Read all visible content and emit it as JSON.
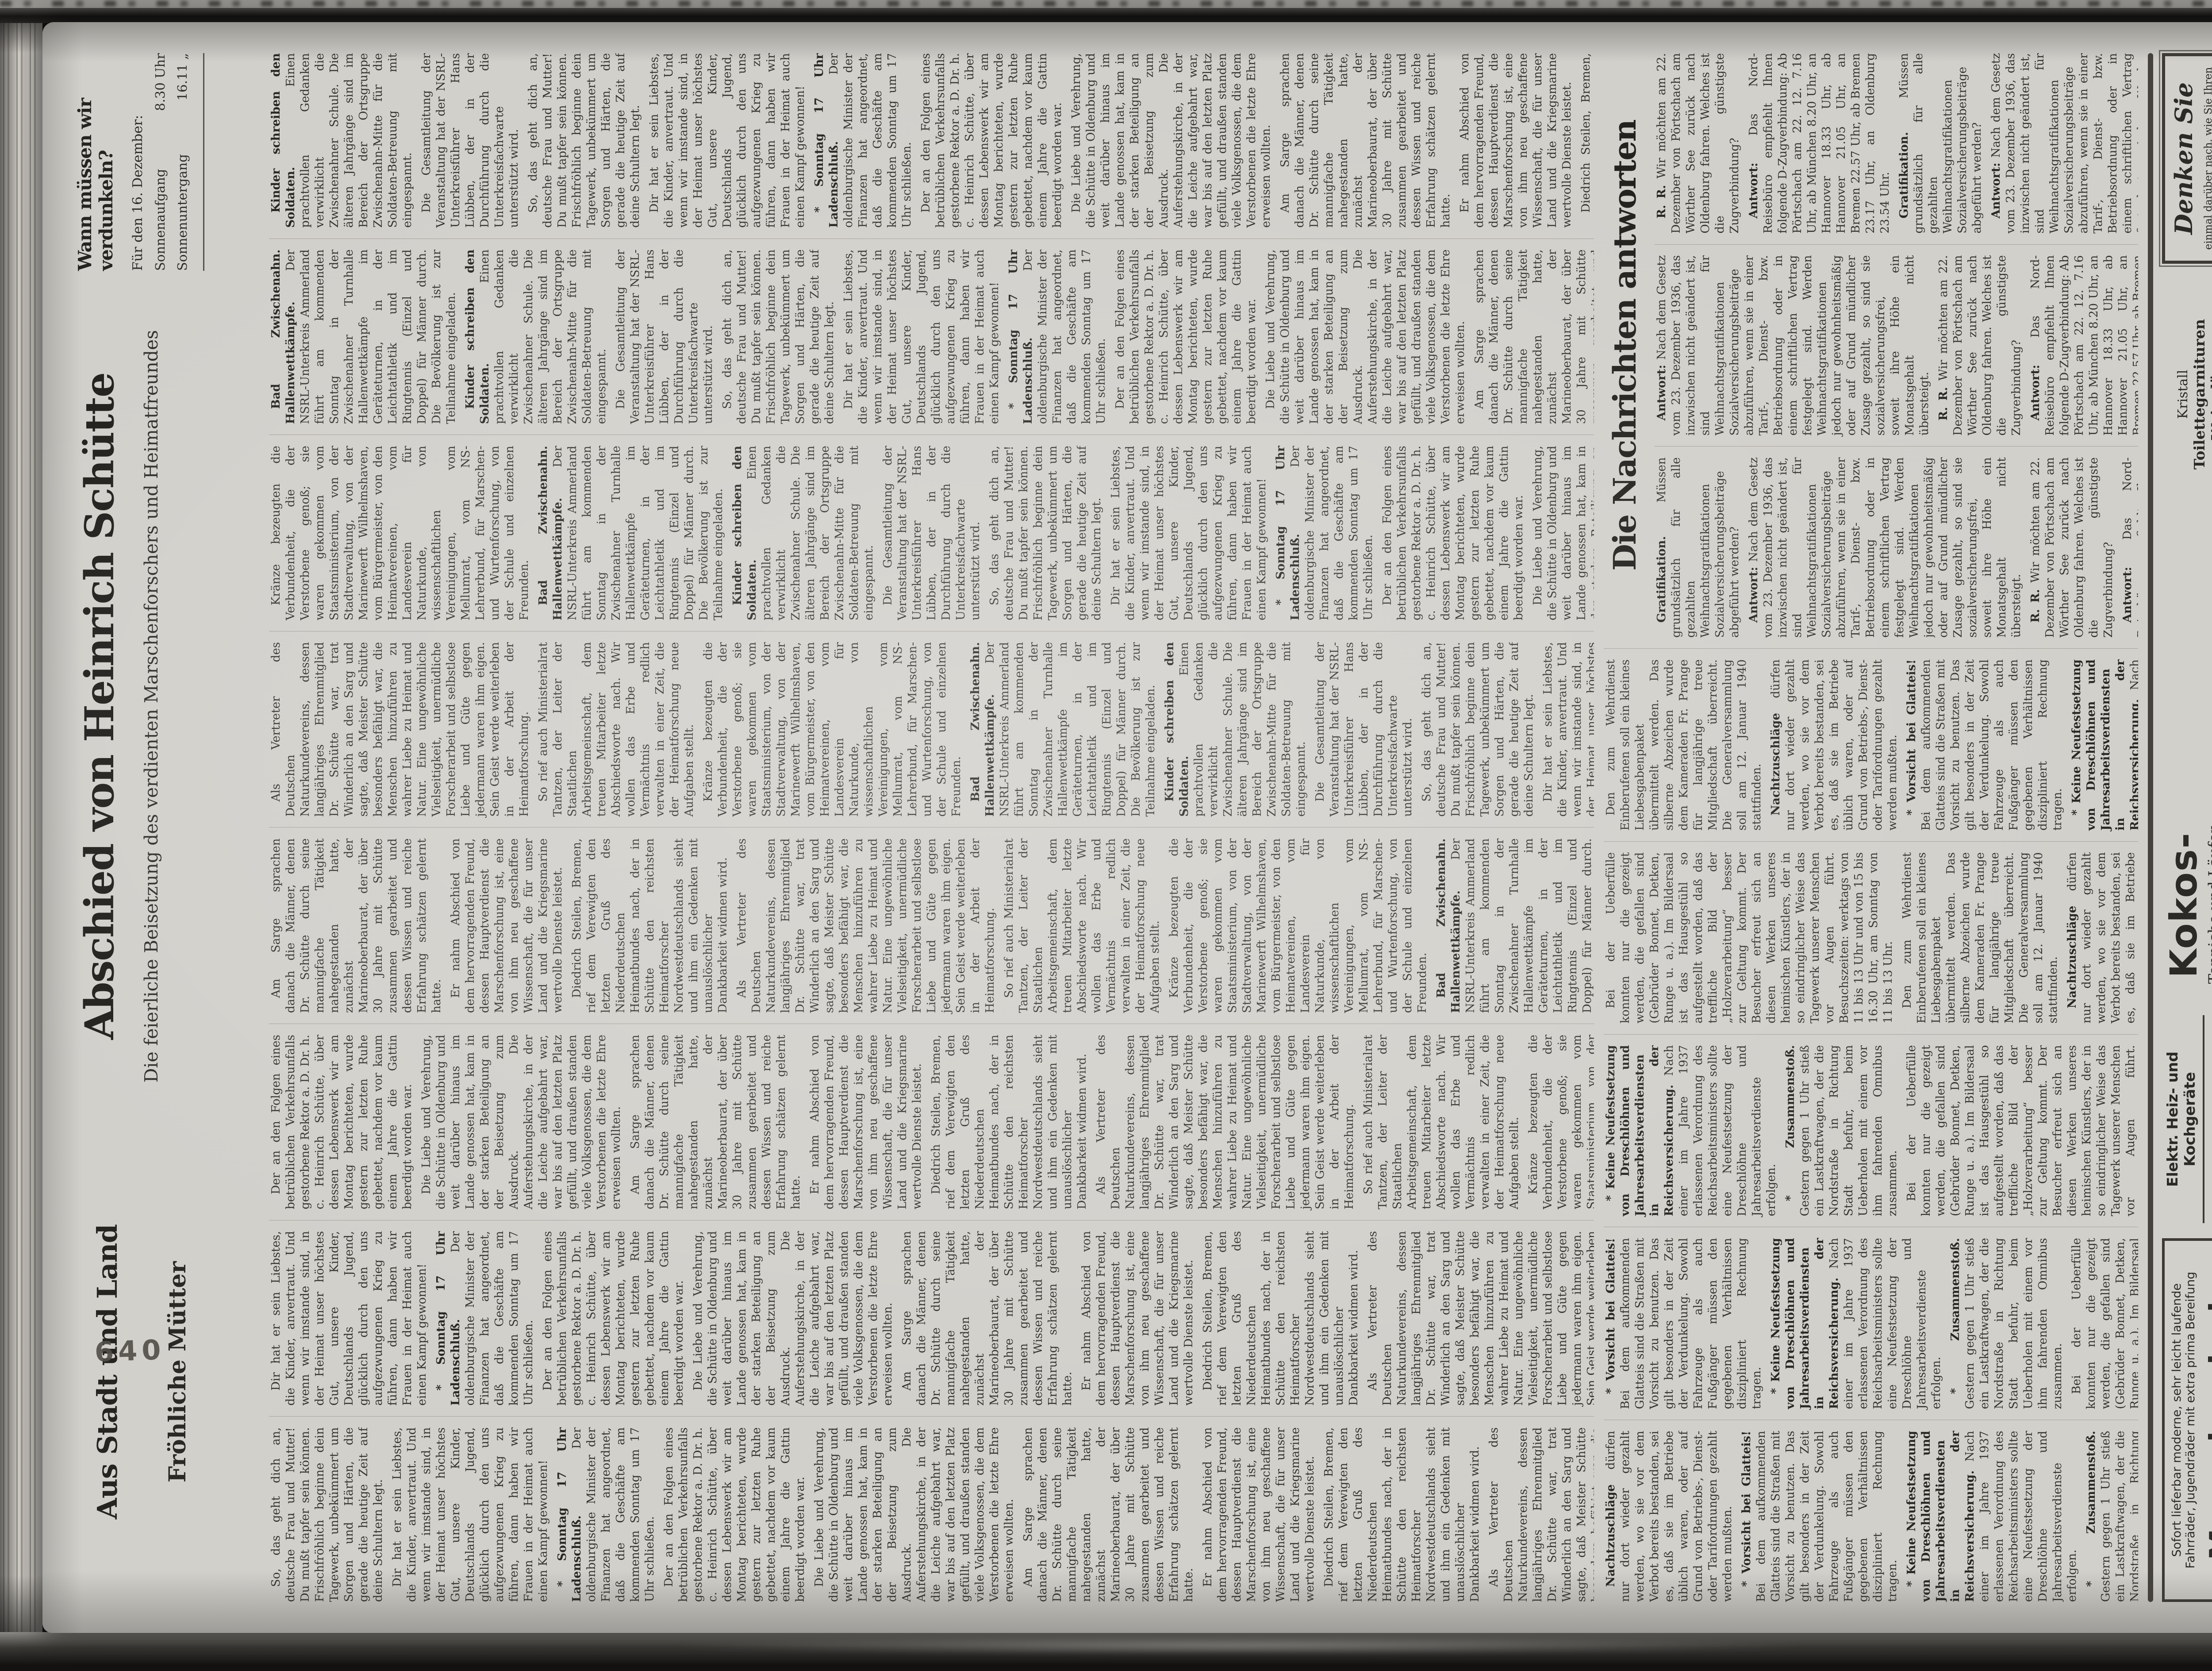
{
  "page": {
    "folio_stamp": "640",
    "colors": {
      "paper": "#d2d0cb",
      "ink": "#2f2d2a",
      "surround": "#141312"
    }
  },
  "headers": {
    "local": {
      "title": "Aus Stadt und Land",
      "subhead": "Fröhliche Mütter"
    },
    "obituary": {
      "title": "Abschied von Heinrich Schütte",
      "subtitle": "Die feierliche Beisetzung des verdienten Marschenforschers und Heimatfreundes"
    },
    "blackout": {
      "title": "Wann müssen wir verdunkeln?",
      "dateline": "Für den 16. Dezember:",
      "rows": [
        {
          "label": "Sonnenaufgang",
          "value": "8.30 Uhr"
        },
        {
          "label": "Sonnenuntergang",
          "value": "16.11 „"
        }
      ]
    },
    "qa_section": {
      "title": "Die Nachrichten antworten"
    }
  },
  "body_pools": {
    "main": [
      {
        "lead": "",
        "text": "So, das geht dich an, deutsche Frau und Mutter! Du mußt tapfer sein können. Frischfröhlich beginne dein Tagewerk, unbekümmert um Sorgen und Härten, die gerade die heutige Zeit auf deine Schultern legt."
      },
      {
        "lead": "",
        "text": "Dir hat er sein Liebstes, die Kinder, anvertraut. Und wenn wir imstande sind, in der Heimat unser höchstes Gut, unsere Kinder, Deutschlands Jugend, glücklich durch den uns aufgezwungenen Krieg zu führen, dann haben wir Frauen in der Heimat auch einen Kampf gewonnen!"
      },
      {
        "lead": "* Sonntag 17 Uhr Ladenschluß.",
        "text": "Der oldenburgische Minister der Finanzen hat angeordnet, daß die Geschäfte am kommenden Sonntag um 17 Uhr schließen."
      },
      {
        "lead": "",
        "text": "Der an den Folgen eines betrüblichen Verkehrsunfalls gestorbene Rektor a. D. Dr. h. c. Heinrich Schütte, über dessen Lebenswerk wir am Montag berichteten, wurde gestern zur letzten Ruhe gebettet, nachdem vor kaum einem Jahre die Gattin beerdigt worden war."
      },
      {
        "lead": "",
        "text": "Die Liebe und Verehrung, die Schütte in Oldenburg und weit darüber hinaus im Lande genossen hat, kam in der starken Beteiligung an der Beisetzung zum Ausdruck. Die Auferstehungskirche, in der die Leiche aufgebahrt war, war bis auf den letzten Platz gefüllt, und draußen standen viele Volksgenossen, die dem Verstorbenen die letzte Ehre erweisen wollten."
      },
      {
        "lead": "",
        "text": "Am Sarge sprachen danach die Männer, denen Dr. Schütte durch seine mannigfache Tätigkeit nahegestanden hatte, zunächst der Marineoberbaurat, der über 30 Jahre mit Schütte zusammen gearbeitet und dessen Wissen und reiche Erfahrung schätzen gelernt hatte."
      },
      {
        "lead": "",
        "text": "Er nahm Abschied von dem hervorragenden Freund, dessen Hauptverdienst die Marschenforschung ist, eine von ihm neu geschaffene Wissenschaft, die für unser Land und die Kriegsmarine wertvolle Dienste leistet."
      },
      {
        "lead": "",
        "text": "Diedrich Steilen, Bremen, rief dem Verewigten den letzten Gruß des Niederdeutschen Heimatbundes nach, der in Schütte den reichsten Heimatforscher Nordwestdeutschlands sieht und ihm ein Gedenken mit unauslöschlicher Dankbarkeit widmen wird."
      },
      {
        "lead": "",
        "text": "Als Vertreter des Deutschen Naturkundevereins, dessen langjähriges Ehrenmitglied Dr. Schütte war, trat Winderlich an den Sarg und sagte, daß Meister Schütte besonders befähigt war, die Menschen hinzuführen zu wahrer Liebe zu Heimat und Natur. Eine ungewöhnliche Vielseitigkeit, unermüdliche Forscherarbeit und selbstlose Liebe und Güte gegen jedermann waren ihm eigen. Sein Geist werde weiterleben in der Arbeit der Heimatforschung."
      },
      {
        "lead": "",
        "text": "So rief auch Ministerialrat Tantzen, der Leiter der Staatlichen Arbeitsgemeinschaft, dem treuen Mitarbeiter letzte Abschiedsworte nach. Wir wollen das Erbe und Vermächtnis redlich verwalten in einer Zeit, die der Heimatforschung neue Aufgaben stellt."
      },
      {
        "lead": "",
        "text": "Kränze bezeugten die Verbundenheit, die der Verstorbene genoß; sie waren gekommen vom Staatsministerium, von der Stadtverwaltung, von der Marinewerft Wilhelmshaven, vom Bürgermeister, von den Heimatvereinen, vom Landesverein für Naturkunde, von wissenschaftlichen Vereinigungen, vom Mellumrat, vom NS-Lehrerbund, für Marschen- und Wurtenforschung, von der Schule und einzelnen Freunden."
      },
      {
        "lead": "Bad Zwischenahn. Hallenwettkämpfe.",
        "text": "Der NSRL-Unterkreis Ammerland führt am kommenden Sonntag in der Zwischenahner Turnhalle Hallenwettkämpfe im Geräteturnen, in der Leichtathletik und im Ringtennis (Einzel und Doppel) für Männer durch. Die Bevölkerung ist zur Teilnahme eingeladen."
      },
      {
        "lead": "Kinder schreiben den Soldaten.",
        "text": "Einen prachtvollen Gedanken verwirklicht die Zwischenahner Schule. Die älteren Jahrgänge sind im Bereich der Ortsgruppe Zwischenahn-Mitte für die Soldaten-Betreuung mit eingespannt."
      },
      {
        "lead": "",
        "text": "Die Gesamtleitung der Veranstaltung hat der NSRL-Unterkreisführer Hans Lübben, der in der Durchführung durch die Unterkreisfachwarte unterstützt wird."
      }
    ],
    "briefs": [
      {
        "lead": "Nachtzuschläge",
        "text": "dürfen nur dort wieder gezahlt werden, wo sie vor dem Verbot bereits bestanden, sei es, daß sie im Betriebe üblich waren, oder auf Grund von Betriebs-, Dienst- oder Tarifordnungen gezahlt werden mußten."
      },
      {
        "lead": "* Vorsicht bei Glatteis!",
        "text": "Bei dem aufkommenden Glatteis sind die Straßen mit Vorsicht zu benutzen. Das gilt besonders in der Zeit der Verdunkelung. Sowohl Fahrzeuge als auch Fußgänger müssen den gegebenen Verhältnissen diszipliniert Rechnung tragen."
      },
      {
        "lead": "* Keine Neufestsetzung von Dreschlöhnen und Jahresarbeitsverdiensten in der Reichsversicherung.",
        "text": "Nach einer im Jahre 1937 erlassenen Verordnung des Reichsarbeitsministers sollte eine Neufestsetzung der Dreschlöhne und Jahresarbeitsverdienste erfolgen."
      },
      {
        "lead": "* Zusammenstoß.",
        "text": "Gestern gegen 1 Uhr stieß ein Lastkraftwagen, der die Nordstraße in Richtung Stadt befuhr, beim Ueberholen mit einem vor ihm fahrenden Omnibus zusammen."
      },
      {
        "lead": "",
        "text": "Bei der Ueberfülle konnten nur die gezeigt werden, die gefallen sind (Gebrüder Bonnet, Detken, Runge u. a.). Im Bildersaal ist das Hausgestühl so aufgestellt worden, daß das treffliche Bild der „Holzverarbeitung“ besser zur Geltung kommt. Der Besucher erfreut sich an diesen Werken unseres heimischen Künstlers, der in so eindringlicher Weise das Tagewerk unserer Menschen vor Augen führt. Besuchszeiten: werktags von 11 bis 13 Uhr und von 15 bis 16.30 Uhr, am Sonntag von 11 bis 13 Uhr."
      },
      {
        "lead": "",
        "text": "Den zum Wehrdienst Einberufenen soll ein kleines Liebesgabenpaket übermittelt werden. Das silberne Abzeichen wurde dem Kameraden Fr. Prange für langjährige treue Mitgliedschaft überreicht. Die Generalversammlung soll am 12. Januar 1940 stattfinden."
      }
    ],
    "qa": [
      {
        "lead": "Gratifikation.",
        "text": "Müssen grundsätzlich für alle gezahlten Weihnachtsgratifikationen Sozialversicherungsbeiträge abgeführt werden?"
      },
      {
        "lead": "Antwort:",
        "text": "Nach dem Gesetz vom 23. Dezember 1936, das inzwischen nicht geändert ist, sind für Weihnachtsgratifikationen Sozialversicherungsbeiträge abzuführen, wenn sie in einer Tarif-, Dienst- bzw. Betriebsordnung oder in einem schriftlichen Vertrag festgelegt sind. Werden Weihnachtsgratifikationen jedoch nur gewohnheitsmäßig oder auf Grund mündlicher Zusage gezahlt, so sind sie sozialversicherungsfrei, soweit ihre Höhe ein Monatsgehalt nicht übersteigt."
      },
      {
        "lead": "R. R.",
        "text": "Wir möchten am 22. Dezember von Pörtschach am Wörther See zurück nach Oldenburg fahren. Welches ist die günstigste Zugverbindung?"
      },
      {
        "lead": "Antwort:",
        "text": "Das Nord-Reisebüro empfiehlt Ihnen folgende D-Zugverbindung: Ab Pörtschach am 22. 12. 7.16 Uhr, ab München 8.20 Uhr, an Hannover 18.33 Uhr, ab Hannover 21.05 Uhr, an Bremen 22.57 Uhr, ab Bremen 23.17 Uhr, an Oldenburg 23.54 Uhr."
      }
    ]
  },
  "ads": {
    "munderloh": {
      "line1": "Sofort lieferbar moderne, sehr leicht laufende",
      "line2": "Fahrräder, Jugendräder mit extra prima Bereifung",
      "name": "Munderloh",
      "address": "Oldenburg, Lange Straße 78"
    },
    "stoever": {
      "line1": "Elektr. Heiz- und Kochgeräte",
      "product": "Gasherde",
      "name": "Fritz Stöver",
      "address": "Staustr. 9"
    },
    "kokos": {
      "big": "Kokos-",
      "line2": "Teppiche und Läufer",
      "name": "Aug. Gellermann",
      "address": "Haarenstraße 53"
    },
    "voss": {
      "k1": "Kristall",
      "k2": "Toilettegarnituren",
      "k3": "Weingläser",
      "name": "Joh. Voss",
      "address": "Nadorster Str. 84"
    },
    "denken": {
      "title": "Denken Sie",
      "body": "einmal darüber nach, wie Sie Ihren Umsatz steigern können. Sie inserieren dann bestimmt in den „Nachrichten“"
    }
  }
}
